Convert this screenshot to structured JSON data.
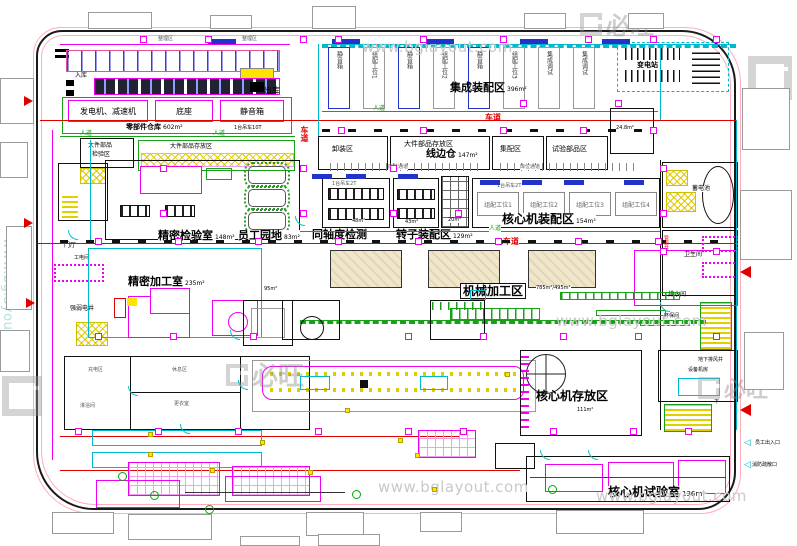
{
  "watermark": {
    "url": "www.bglayout.com",
    "logo": "必旺"
  },
  "lanes": {
    "vehicle": "车道",
    "pedestrian": "人道"
  },
  "topLeft": {
    "tinyA": "整理区",
    "tinyB": "整理区",
    "inLabel": "入库",
    "outLabel": "出库",
    "rooms": [
      "发电机、减速机",
      "底座",
      "静音箱"
    ],
    "warehouse": "零部件仓库",
    "warehouseArea": "602m²",
    "crane": "1台吊车10T"
  },
  "topMid": {
    "title": "集成装配区",
    "area": "396m²",
    "bays": [
      "静音箱",
      "组配工位1",
      "静音箱",
      "组配工位2",
      "静音箱",
      "组配工位3",
      "集成调试",
      "集成调试"
    ]
  },
  "topRight": {
    "substation": "变电站",
    "mezzArea": "24.8m²"
  },
  "storageRow": {
    "inspect1": "大件部品",
    "inspect2": "检验区",
    "storageLeft": "大件部品存放区",
    "unload": "卸装区",
    "storageMid": "大件部品存放区",
    "lineSide": "线边仓",
    "lineSideArea": "147m²",
    "collect": "集配区",
    "testParts": "试验部品区",
    "aisleLeft": "库位通道",
    "aisleRight": "库位通道"
  },
  "midRow": {
    "inspection": "精密检验室",
    "inspectionArea": "148m²",
    "staff": "员工园地",
    "staffArea": "83m²",
    "coax": "同轴度检测",
    "coaxArea": "48m²",
    "crane": "1台吊车2T",
    "crane2": "1台吊车2T",
    "rotor": "转子装配区",
    "rotorArea": "129m²",
    "rotorSub": "43m²",
    "rackArea": "20m²",
    "core": "核心机装配区",
    "coreArea": "154m²",
    "coreBays": [
      "组配工位1",
      "组配工位2",
      "组配工位3",
      "组配工位4"
    ]
  },
  "leftCol": {
    "hall": "门厅",
    "tool": "工电间",
    "shaft": "强弱电井"
  },
  "rightCol": {
    "battery": "蓄电池",
    "duct": "管道井",
    "toilet": "卫生间",
    "drain": "排水间",
    "env": "环保间",
    "down": "下"
  },
  "machining": {
    "precision": "精密加工室",
    "precisionArea": "235m²",
    "sub": "175m²",
    "right": "95m²",
    "mech": "机械加工区",
    "mechArea1": "785m²",
    "mechArea2": "495m²"
  },
  "bottom": {
    "rooms": [
      "充电区",
      "休息区",
      "更衣室",
      "淋浴间"
    ],
    "coreStore": "核心机存放区",
    "coreStoreArea": "111m²",
    "fan": "地下排风井",
    "plant": "设备机房",
    "down": "下",
    "coreTest": "核心机试验室",
    "coreTestArea": "136m²"
  },
  "callouts": {
    "entry": "员工出入口",
    "fire": "消防疏散口"
  }
}
